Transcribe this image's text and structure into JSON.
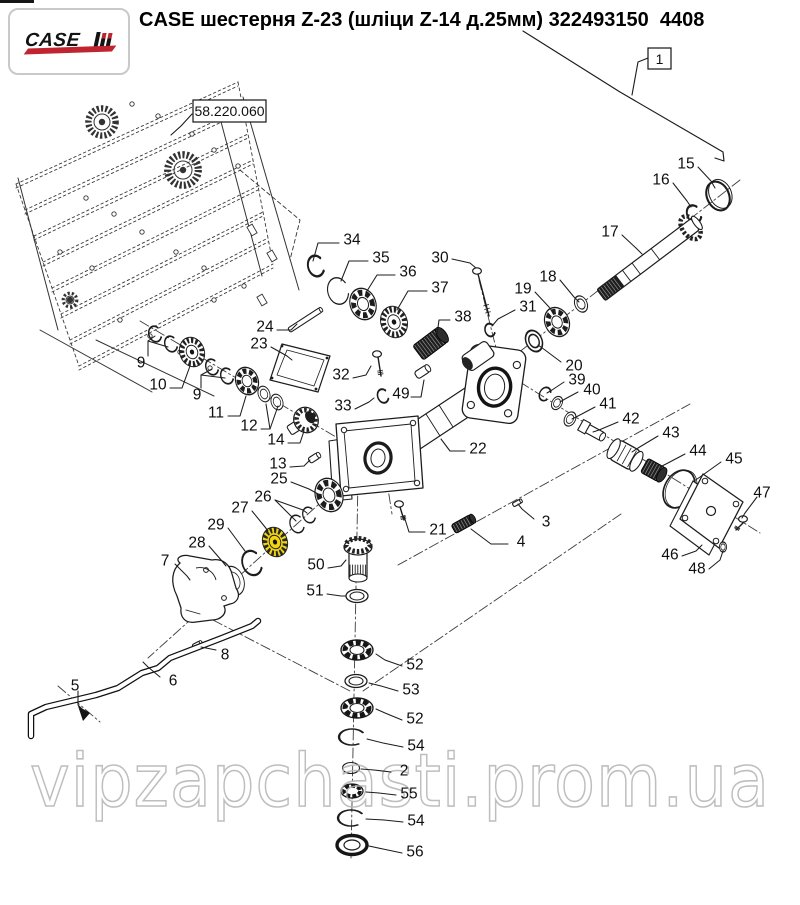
{
  "header": {
    "title": "CASE шестерня Z-23 (шліци Z-14 д.25мм) 322493150  4408",
    "logo_case": "CASE"
  },
  "diagram": {
    "section_ref": "58.220.060",
    "assembly_ref": "1",
    "watermark": "vipzapchasti.prom.ua",
    "highlight_color": "#f0d414",
    "callouts": [
      {
        "label": "34",
        "x": 352,
        "y": 239,
        "leads": [
          [
            [
              339,
              243
            ],
            [
              318,
              243
            ],
            [
              313,
              261
            ]
          ]
        ]
      },
      {
        "label": "35",
        "x": 381,
        "y": 257,
        "leads": [
          [
            [
              368,
              261
            ],
            [
              349,
              261
            ],
            [
              341,
              281
            ]
          ]
        ]
      },
      {
        "label": "36",
        "x": 408,
        "y": 271,
        "leads": [
          [
            [
              395,
              275
            ],
            [
              377,
              275
            ],
            [
              367,
              291
            ]
          ]
        ]
      },
      {
        "label": "37",
        "x": 440,
        "y": 287,
        "leads": [
          [
            [
              427,
              291
            ],
            [
              408,
              291
            ],
            [
              397,
              310
            ]
          ]
        ]
      },
      {
        "label": "38",
        "x": 463,
        "y": 316,
        "leads": [
          [
            [
              450,
              320
            ],
            [
              439,
              320
            ],
            [
              437,
              335
            ]
          ]
        ]
      },
      {
        "label": "30",
        "x": 440,
        "y": 257,
        "leads": [
          [
            [
              452,
              259
            ],
            [
              470,
              263
            ],
            [
              476,
              268
            ]
          ]
        ]
      },
      {
        "label": "19",
        "x": 523,
        "y": 288,
        "leads": [
          [
            [
              535,
              292
            ],
            [
              549,
              307
            ],
            [
              554,
              314
            ]
          ]
        ]
      },
      {
        "label": "31",
        "x": 528,
        "y": 306,
        "leads": [
          [
            [
              515,
              310
            ],
            [
              498,
              319
            ],
            [
              492,
              326
            ]
          ]
        ]
      },
      {
        "label": "18",
        "x": 548,
        "y": 276,
        "leads": [
          [
            [
              560,
              280
            ],
            [
              574,
              297
            ],
            [
              579,
              302
            ]
          ]
        ]
      },
      {
        "label": "20",
        "x": 574,
        "y": 365,
        "leads": [
          [
            [
              561,
              362
            ],
            [
              545,
              350
            ],
            [
              538,
              345
            ]
          ]
        ]
      },
      {
        "label": "15",
        "x": 686,
        "y": 163,
        "leads": [
          [
            [
              698,
              167
            ],
            [
              711,
              181
            ],
            [
              715,
              188
            ]
          ]
        ]
      },
      {
        "label": "16",
        "x": 661,
        "y": 179,
        "leads": [
          [
            [
              673,
              183
            ],
            [
              687,
              201
            ],
            [
              691,
              207
            ]
          ]
        ]
      },
      {
        "label": "17",
        "x": 610,
        "y": 231,
        "leads": [
          [
            [
              622,
              235
            ],
            [
              637,
              249
            ],
            [
              642,
              254
            ]
          ]
        ]
      },
      {
        "label": "24",
        "x": 265,
        "y": 326,
        "leads": [
          [
            [
              277,
              330
            ],
            [
              291,
              330
            ],
            [
              297,
              324
            ]
          ]
        ]
      },
      {
        "label": "23",
        "x": 259,
        "y": 343,
        "leads": [
          [
            [
              271,
              347
            ],
            [
              287,
              356
            ],
            [
              292,
              360
            ]
          ]
        ]
      },
      {
        "label": "9",
        "x": 141,
        "y": 362,
        "leads": [
          [
            [
              148,
              356
            ],
            [
              148,
              341
            ],
            [
              155,
              336
            ]
          ],
          [
            [
              148,
              341
            ],
            [
              168,
              347
            ]
          ]
        ]
      },
      {
        "label": "10",
        "x": 158,
        "y": 384,
        "leads": [
          [
            [
              170,
              388
            ],
            [
              182,
              388
            ],
            [
              190,
              366
            ]
          ]
        ]
      },
      {
        "label": "9",
        "x": 197,
        "y": 394,
        "leads": [
          [
            [
              201,
              388
            ],
            [
              201,
              375
            ],
            [
              212,
              369
            ]
          ],
          [
            [
              201,
              375
            ],
            [
              225,
              378
            ]
          ]
        ]
      },
      {
        "label": "11",
        "x": 216,
        "y": 412,
        "leads": [
          [
            [
              228,
              416
            ],
            [
              240,
              416
            ],
            [
              246,
              396
            ]
          ]
        ]
      },
      {
        "label": "12",
        "x": 249,
        "y": 425,
        "leads": [
          [
            [
              261,
              429
            ],
            [
              270,
              429
            ],
            [
              266,
              404
            ]
          ],
          [
            [
              270,
              429
            ],
            [
              278,
              406
            ]
          ]
        ]
      },
      {
        "label": "14",
        "x": 276,
        "y": 439,
        "leads": [
          [
            [
              288,
              443
            ],
            [
              300,
              443
            ],
            [
              304,
              431
            ]
          ]
        ]
      },
      {
        "label": "13",
        "x": 278,
        "y": 463,
        "leads": [
          [
            [
              290,
              467
            ],
            [
              304,
              466
            ],
            [
              310,
              460
            ]
          ]
        ]
      },
      {
        "label": "25",
        "x": 279,
        "y": 478,
        "leads": [
          [
            [
              291,
              482
            ],
            [
              309,
              489
            ],
            [
              320,
              495
            ]
          ]
        ]
      },
      {
        "label": "26",
        "x": 263,
        "y": 496,
        "leads": [
          [
            [
              275,
              500
            ],
            [
              292,
              517
            ],
            [
              296,
              521
            ]
          ],
          [
            [
              275,
              500
            ],
            [
              303,
              510
            ],
            [
              307,
              513
            ]
          ]
        ]
      },
      {
        "label": "27",
        "x": 240,
        "y": 507,
        "leads": [
          [
            [
              252,
              511
            ],
            [
              265,
              527
            ],
            [
              268,
              531
            ]
          ]
        ]
      },
      {
        "label": "29",
        "x": 216,
        "y": 524,
        "leads": [
          [
            [
              228,
              528
            ],
            [
              242,
              547
            ],
            [
              245,
              551
            ]
          ]
        ]
      },
      {
        "label": "28",
        "x": 197,
        "y": 542,
        "leads": [
          [
            [
              209,
              546
            ],
            [
              222,
              561
            ],
            [
              226,
              566
            ]
          ]
        ]
      },
      {
        "label": "7",
        "x": 165,
        "y": 560,
        "leads": [
          [
            [
              175,
              564
            ],
            [
              187,
              576
            ],
            [
              190,
              580
            ]
          ]
        ]
      },
      {
        "label": "50",
        "x": 316,
        "y": 564,
        "leads": [
          [
            [
              328,
              568
            ],
            [
              341,
              566
            ],
            [
              346,
              560
            ]
          ]
        ]
      },
      {
        "label": "51",
        "x": 315,
        "y": 590,
        "leads": [
          [
            [
              327,
              594
            ],
            [
              341,
              596
            ],
            [
              346,
              596
            ]
          ]
        ]
      },
      {
        "label": "22",
        "x": 478,
        "y": 448,
        "leads": [
          [
            [
              465,
              451
            ],
            [
              450,
              451
            ],
            [
              441,
              439
            ]
          ]
        ]
      },
      {
        "label": "21",
        "x": 438,
        "y": 529,
        "leads": [
          [
            [
              425,
              532
            ],
            [
              409,
              532
            ],
            [
              404,
              516
            ]
          ]
        ]
      },
      {
        "label": "49",
        "x": 401,
        "y": 393,
        "leads": [
          [
            [
              411,
              397
            ],
            [
              421,
              397
            ],
            [
              424,
              380
            ]
          ]
        ]
      },
      {
        "label": "32",
        "x": 341,
        "y": 374,
        "leads": [
          [
            [
              353,
              378
            ],
            [
              366,
              375
            ],
            [
              371,
              366
            ]
          ]
        ]
      },
      {
        "label": "33",
        "x": 343,
        "y": 405,
        "leads": [
          [
            [
              355,
              409
            ],
            [
              369,
              402
            ],
            [
              374,
              398
            ]
          ]
        ]
      },
      {
        "label": "3",
        "x": 546,
        "y": 521,
        "leads": [
          [
            [
              534,
              519
            ],
            [
              522,
              509
            ],
            [
              518,
              504
            ]
          ]
        ]
      },
      {
        "label": "4",
        "x": 521,
        "y": 541,
        "leads": [
          [
            [
              508,
              544
            ],
            [
              491,
              544
            ],
            [
              471,
              529
            ]
          ]
        ]
      },
      {
        "label": "39",
        "x": 577,
        "y": 379,
        "leads": [
          [
            [
              564,
              382
            ],
            [
              552,
              390
            ],
            [
              547,
              393
            ]
          ]
        ]
      },
      {
        "label": "40",
        "x": 592,
        "y": 389,
        "leads": [
          [
            [
              578,
              392
            ],
            [
              565,
              399
            ],
            [
              560,
              402
            ]
          ]
        ]
      },
      {
        "label": "41",
        "x": 608,
        "y": 403,
        "leads": [
          [
            [
              595,
              407
            ],
            [
              578,
              416
            ],
            [
              572,
              419
            ]
          ]
        ]
      },
      {
        "label": "42",
        "x": 631,
        "y": 418,
        "leads": [
          [
            [
              618,
              422
            ],
            [
              599,
              430
            ],
            [
              593,
              432
            ]
          ]
        ]
      },
      {
        "label": "43",
        "x": 671,
        "y": 432,
        "leads": [
          [
            [
              658,
              436
            ],
            [
              638,
              448
            ],
            [
              632,
              452
            ]
          ]
        ]
      },
      {
        "label": "44",
        "x": 698,
        "y": 450,
        "leads": [
          [
            [
              685,
              454
            ],
            [
              666,
              464
            ],
            [
              660,
              467
            ]
          ]
        ]
      },
      {
        "label": "45",
        "x": 734,
        "y": 458,
        "leads": [
          [
            [
              721,
              462
            ],
            [
              700,
              477
            ],
            [
              694,
              481
            ]
          ]
        ]
      },
      {
        "label": "47",
        "x": 762,
        "y": 492,
        "leads": [
          [
            [
              757,
              497
            ],
            [
              745,
              513
            ],
            [
              742,
              518
            ]
          ]
        ]
      },
      {
        "label": "46",
        "x": 670,
        "y": 554,
        "leads": [
          [
            [
              682,
              556
            ],
            [
              696,
              551
            ],
            [
              702,
              545
            ]
          ]
        ]
      },
      {
        "label": "48",
        "x": 697,
        "y": 568,
        "leads": [
          [
            [
              709,
              569
            ],
            [
              720,
              560
            ],
            [
              723,
              551
            ]
          ]
        ]
      },
      {
        "label": "52",
        "x": 415,
        "y": 664,
        "leads": [
          [
            [
              402,
              666
            ],
            [
              385,
              660
            ],
            [
              376,
              654
            ]
          ]
        ]
      },
      {
        "label": "53",
        "x": 411,
        "y": 689,
        "leads": [
          [
            [
              398,
              691
            ],
            [
              381,
              686
            ],
            [
              369,
              683
            ]
          ]
        ]
      },
      {
        "label": "52",
        "x": 415,
        "y": 718,
        "leads": [
          [
            [
              402,
              720
            ],
            [
              385,
              713
            ],
            [
              376,
              709
            ]
          ]
        ]
      },
      {
        "label": "54",
        "x": 416,
        "y": 745,
        "leads": [
          [
            [
              403,
              747
            ],
            [
              383,
              743
            ],
            [
              367,
              739
            ]
          ]
        ]
      },
      {
        "label": "2",
        "x": 404,
        "y": 770,
        "leads": [
          [
            [
              391,
              772
            ],
            [
              374,
              770
            ],
            [
              361,
              769
            ]
          ]
        ]
      },
      {
        "label": "55",
        "x": 409,
        "y": 793,
        "leads": [
          [
            [
              396,
              795
            ],
            [
              379,
              793
            ],
            [
              366,
              792
            ]
          ]
        ]
      },
      {
        "label": "54",
        "x": 416,
        "y": 820,
        "leads": [
          [
            [
              403,
              822
            ],
            [
              384,
              820
            ],
            [
              366,
              819
            ]
          ]
        ]
      },
      {
        "label": "56",
        "x": 415,
        "y": 851,
        "leads": [
          [
            [
              402,
              853
            ],
            [
              383,
              849
            ],
            [
              369,
              846
            ]
          ]
        ]
      },
      {
        "label": "8",
        "x": 225,
        "y": 654,
        "leads": [
          [
            [
              216,
              650
            ],
            [
              201,
              647
            ]
          ]
        ]
      },
      {
        "label": "6",
        "x": 173,
        "y": 680,
        "leads": [
          [
            [
              160,
              677
            ],
            [
              148,
              667
            ],
            [
              143,
              662
            ]
          ]
        ]
      },
      {
        "label": "5",
        "x": 75,
        "y": 685,
        "leads": [
          [
            [
              78,
              691
            ],
            [
              78,
              705
            ],
            [
              84,
              711
            ]
          ]
        ]
      }
    ]
  }
}
